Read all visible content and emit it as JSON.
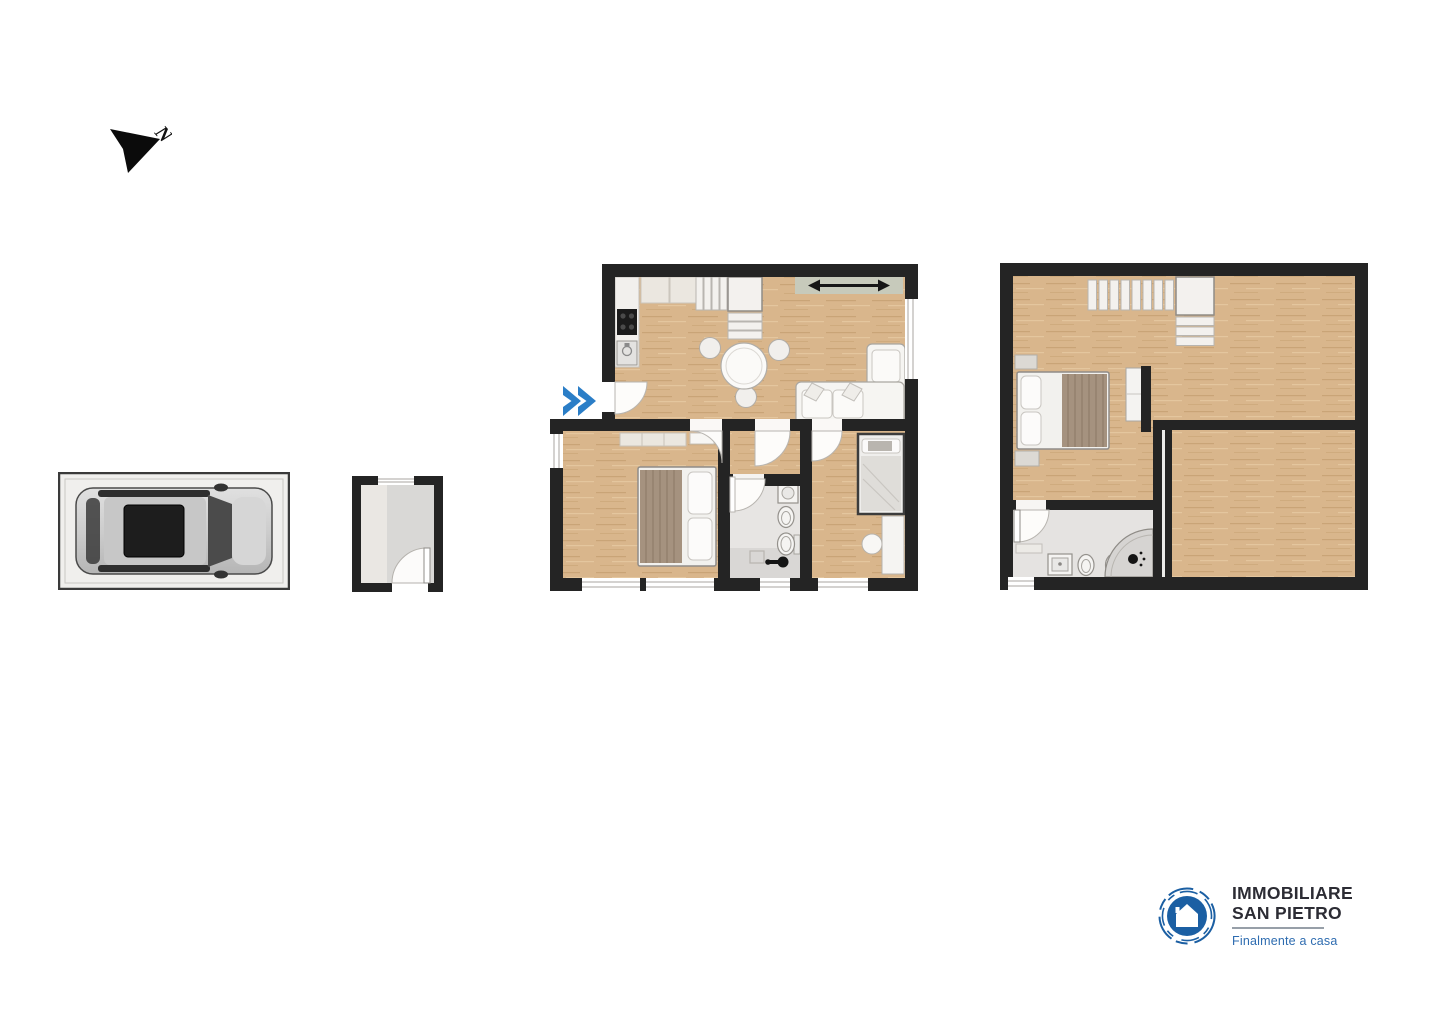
{
  "sheet": {
    "kind": "real-estate floor plan sheet",
    "background": "#ffffff"
  },
  "north_indicator": {
    "label": "N",
    "icon": "north-arrow-icon",
    "color": "#0b0b0b"
  },
  "entrance_marker": {
    "icon": "double-chevron-right-icon",
    "color": "#2b7ec7"
  },
  "palette": {
    "wall": "#242424",
    "wood_floor": "#d9b68c",
    "wood_line_dark": "#c9a477",
    "wood_line_light": "#e4c69e",
    "tile_floor": "#e6e4e2",
    "shower_tile": "#d8d6d4",
    "furniture_white": "#f5f4f2",
    "furniture_beige": "#ebe7df",
    "balcony_strip": "#c7cabb",
    "blanket_brown": "#a5927f",
    "car_body_silver": "#cfcfcf",
    "accent_blue": "#2b7ec7"
  },
  "plans": {
    "garage": {
      "name": "garage",
      "contents": [
        "car-top-view-icon"
      ]
    },
    "storage_room": {
      "name": "storage room",
      "contents": [
        "door-arc",
        "window"
      ]
    },
    "ground_floor": {
      "name": "main floor",
      "rooms": [
        "kitchen-living-room",
        "bedroom",
        "bathroom",
        "small-bedroom"
      ],
      "contents": [
        "stove-icon",
        "kitchen-sink-icon",
        "stairs-icon",
        "balcony-door-arrow-icon",
        "dining-table-icon",
        "sofa-icon",
        "double-bed-icon",
        "wardrobe-icon",
        "washbasin-icon",
        "bidet-icon",
        "toilet-icon",
        "shower-icon",
        "single-bed-icon",
        "desk-icon"
      ]
    },
    "upper_floor": {
      "name": "upper floor",
      "rooms": [
        "open-room",
        "bedroom",
        "bathroom",
        "large-room"
      ],
      "contents": [
        "stairs-icon",
        "double-bed-icon",
        "nightstand-icon",
        "wardrobe-icon",
        "washbasin-icon",
        "bidet-icon",
        "toilet-icon",
        "corner-shower-icon"
      ]
    }
  },
  "logo": {
    "line1": "IMMOBILIARE",
    "line2": "SAN PIETRO",
    "tagline": "Finalmente a casa",
    "icon": "house-in-circle-icon",
    "primary_blue": "#1b5fa3",
    "text_color": "#2c2c34",
    "tagline_color": "#2e6cb0"
  }
}
